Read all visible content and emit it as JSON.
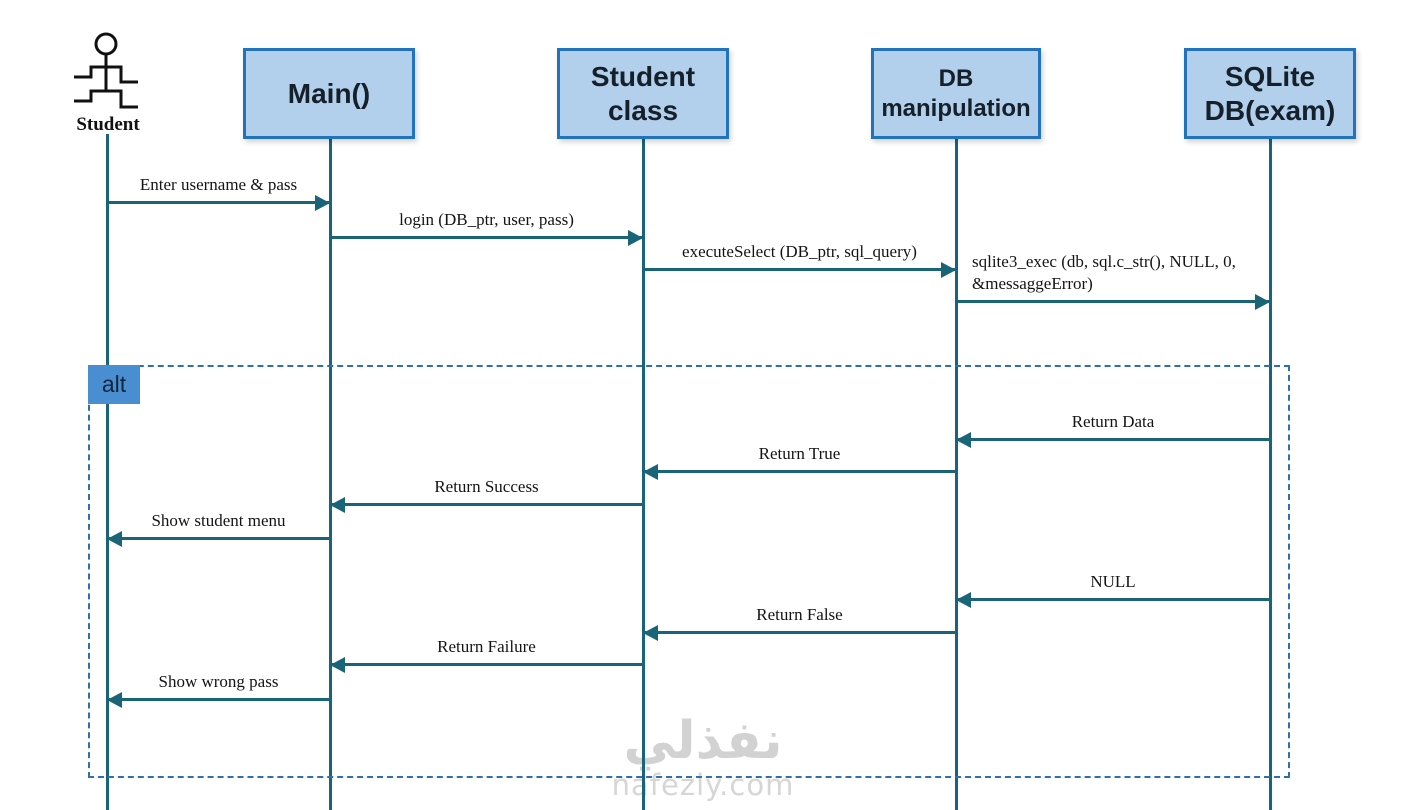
{
  "participants": [
    {
      "label": "Student",
      "type": "actor"
    },
    {
      "label": "Main()",
      "type": "object"
    },
    {
      "label": "Student class",
      "type": "object"
    },
    {
      "label": "DB manipulation",
      "type": "object"
    },
    {
      "label": "SQLite DB(exam)",
      "type": "object"
    }
  ],
  "fragment": {
    "type": "alt",
    "label": "alt"
  },
  "messages": [
    {
      "text": "Enter username & pass",
      "from": "Student",
      "to": "Main()"
    },
    {
      "text": "login (DB_ptr, user, pass)",
      "from": "Main()",
      "to": "Student class"
    },
    {
      "text": "executeSelect (DB_ptr, sql_query)",
      "from": "Student class",
      "to": "DB manipulation"
    },
    {
      "text": "sqlite3_exec (db, sql.c_str(), NULL, 0, &messaggeError)",
      "from": "DB manipulation",
      "to": "SQLite DB(exam)"
    },
    {
      "text": "Return Data",
      "from": "SQLite DB(exam)",
      "to": "DB manipulation"
    },
    {
      "text": "Return True",
      "from": "DB manipulation",
      "to": "Student class"
    },
    {
      "text": "Return Success",
      "from": "Student class",
      "to": "Main()"
    },
    {
      "text": "Show student menu",
      "from": "Main()",
      "to": "Student"
    },
    {
      "text": "NULL",
      "from": "SQLite DB(exam)",
      "to": "DB manipulation"
    },
    {
      "text": "Return False",
      "from": "DB manipulation",
      "to": "Student class"
    },
    {
      "text": "Return Failure",
      "from": "Student class",
      "to": "Main()"
    },
    {
      "text": "Show wrong pass",
      "from": "Main()",
      "to": "Student"
    }
  ],
  "watermark": {
    "logo_text": "نفذلي",
    "site": "nafezly.com"
  },
  "colors": {
    "box_fill": "#b2d0eb",
    "box_border": "#2273bd",
    "line": "#1a6478",
    "fragment_border": "#2f6fad",
    "fragment_tab_fill": "#4a8ed2"
  }
}
